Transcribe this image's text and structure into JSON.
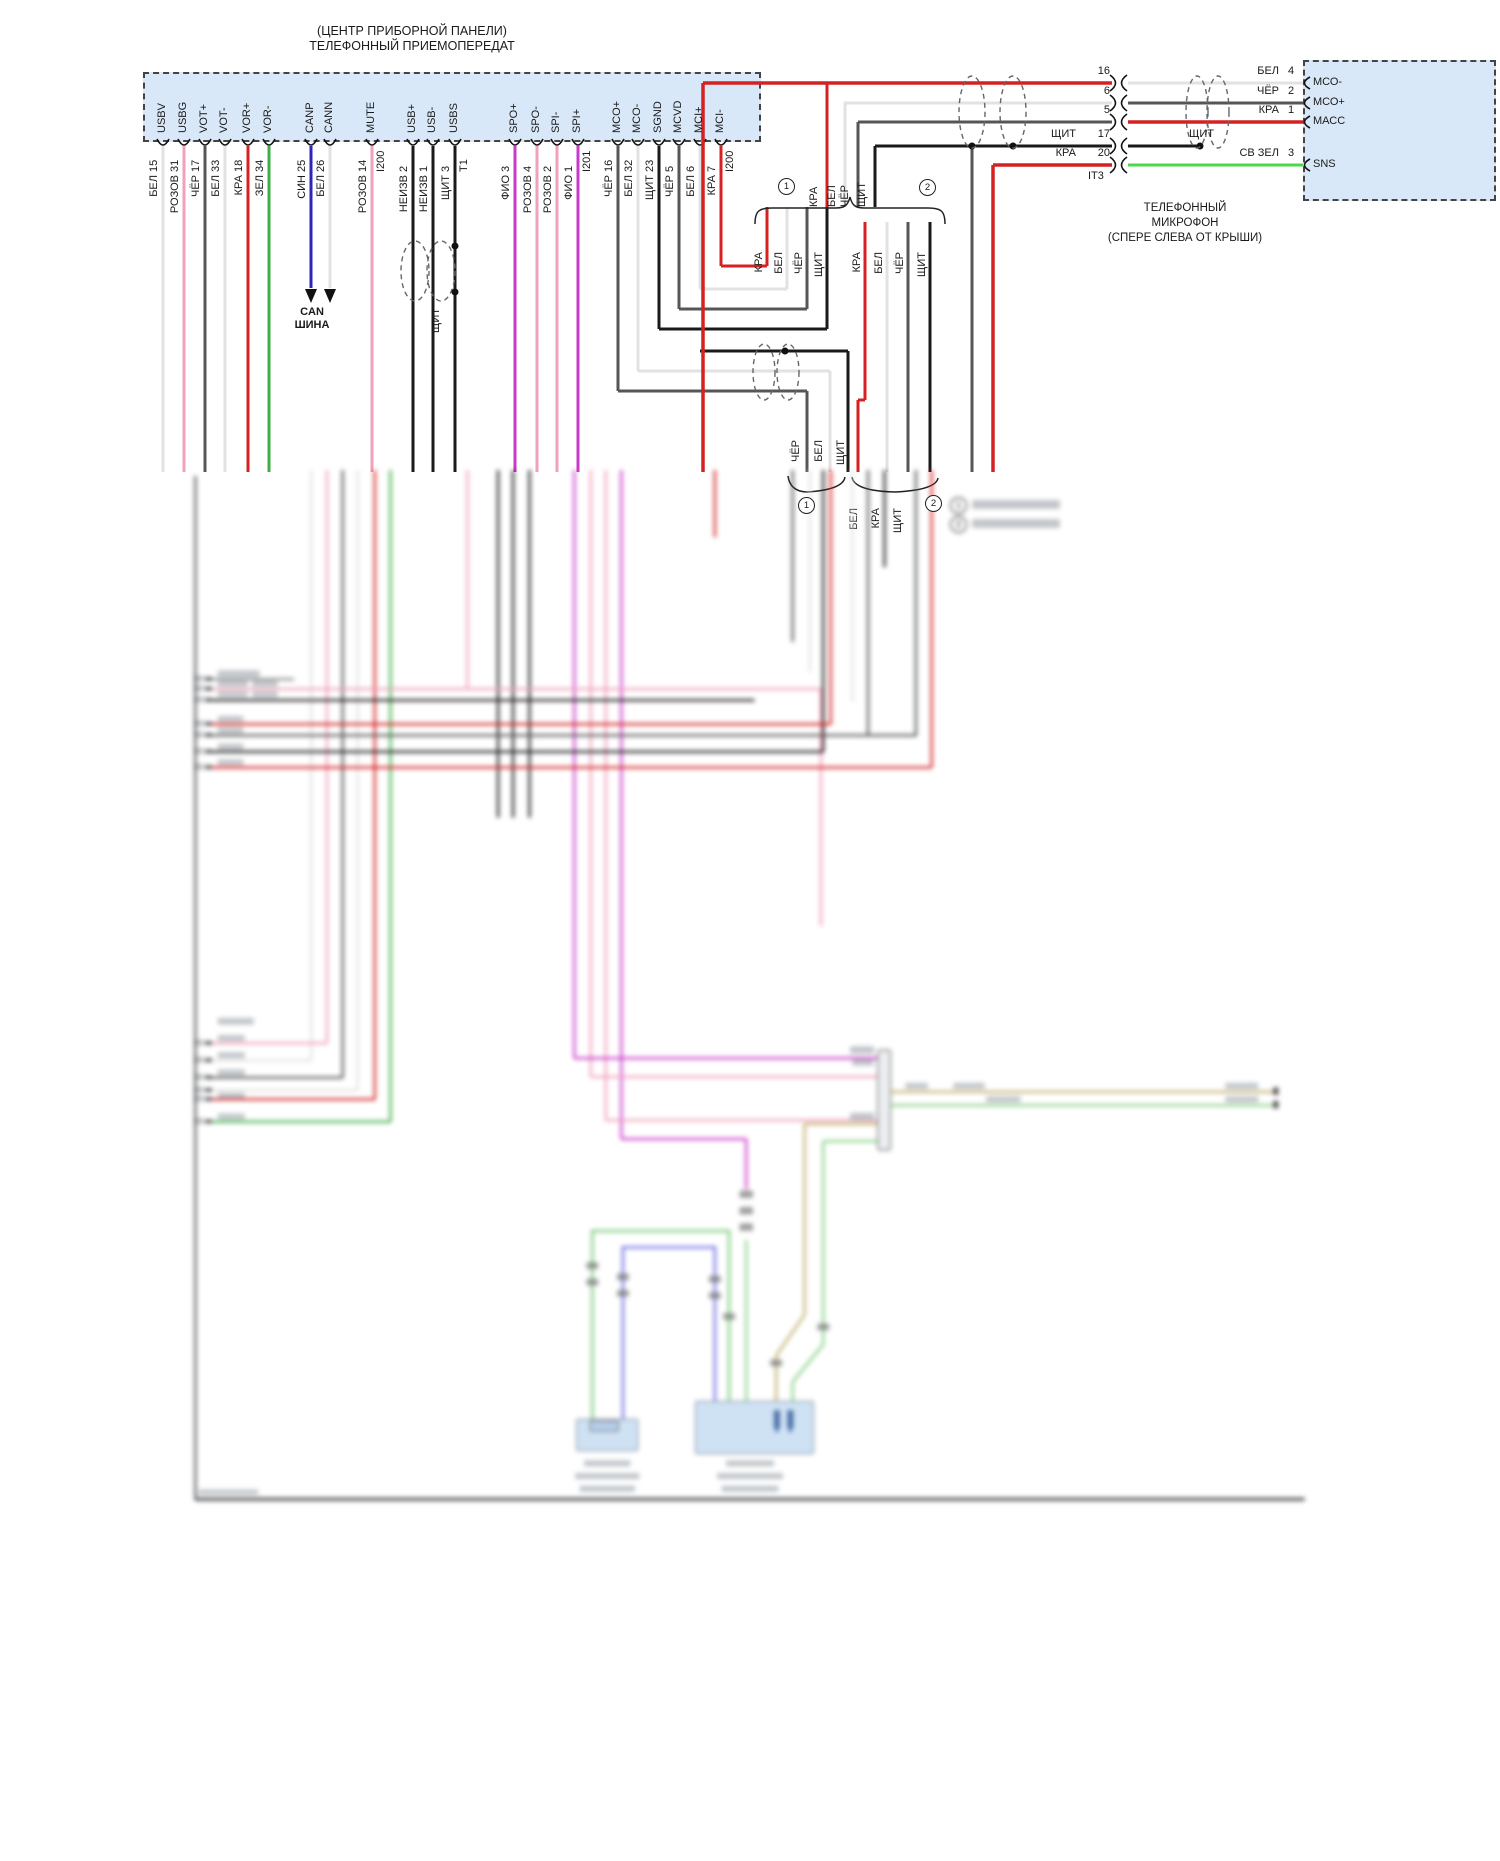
{
  "palette": {
    "BEL": "#e2e2e2",
    "ROZOV": "#f0a2ba",
    "CHER": "#565656",
    "KRA": "#d42222",
    "ZEL": "#3fae47",
    "SIN": "#2c24bd",
    "NEIZV": "#1a1a1a",
    "SHCHIT": "#1a1a1a",
    "FIO": "#c93ac9",
    "SVZEL": "#4ad84a",
    "TAN": "#c0ad6c",
    "BLUE2": "#8080e8",
    "GREEN2": "#86cf86",
    "block_fill": "#d9e8f8"
  },
  "header": {
    "title_line1": "(ЦЕНТР ПРИБОРНОЙ ПАНЕЛИ)",
    "title_line2": "ТЕЛЕФОННЫЙ ПРИЕМОПЕРЕДАТ"
  },
  "transceiver_pins": [
    {
      "label": "USBV",
      "num": "15",
      "wire": "БЕЛ",
      "color": "BEL"
    },
    {
      "label": "USBG",
      "num": "31",
      "wire": "РОЗОВ",
      "color": "ROZOV"
    },
    {
      "label": "VOT+",
      "num": "17",
      "wire": "ЧЁР",
      "color": "CHER"
    },
    {
      "label": "VOT-",
      "num": "33",
      "wire": "БЕЛ",
      "color": "BEL"
    },
    {
      "label": "VOR+",
      "num": "18",
      "wire": "КРА",
      "color": "KRA"
    },
    {
      "label": "VOR-",
      "num": "34",
      "wire": "ЗЕЛ",
      "color": "ZEL"
    },
    {
      "label": "CANP",
      "num": "25",
      "wire": "СИН",
      "color": "SIN"
    },
    {
      "label": "CANN",
      "num": "26",
      "wire": "БЕЛ",
      "color": "BEL"
    },
    {
      "label": "MUTE",
      "num": "14",
      "wire": "РОЗОВ",
      "color": "ROZOV",
      "conn": "I200"
    },
    {
      "label": "USB+",
      "num": "2",
      "wire": "НЕИЗВ",
      "color": "NEIZV"
    },
    {
      "label": "USB-",
      "num": "1",
      "wire": "НЕИЗВ",
      "color": "NEIZV"
    },
    {
      "label": "USBS",
      "num": "3",
      "wire": "ЩИТ",
      "color": "SHCHIT",
      "conn": "T1"
    },
    {
      "label": "SPO+",
      "num": "3",
      "wire": "ФИО",
      "color": "FIO"
    },
    {
      "label": "SPO-",
      "num": "4",
      "wire": "РОЗОВ",
      "color": "ROZOV"
    },
    {
      "label": "SPI-",
      "num": "2",
      "wire": "РОЗОВ",
      "color": "ROZOV"
    },
    {
      "label": "SPI+",
      "num": "1",
      "wire": "ФИО",
      "color": "FIO",
      "conn": "I201"
    },
    {
      "label": "MCO+",
      "num": "16",
      "wire": "ЧЁР",
      "color": "CHER"
    },
    {
      "label": "MCO-",
      "num": "32",
      "wire": "БЕЛ",
      "color": "BEL"
    },
    {
      "label": "SGND",
      "num": "23",
      "wire": "ЩИТ",
      "color": "SHCHIT"
    },
    {
      "label": "MCVD",
      "num": "5",
      "wire": "ЧЁР",
      "color": "CHER"
    },
    {
      "label": "MCI+",
      "num": "6",
      "wire": "БЕЛ",
      "color": "BEL"
    },
    {
      "label": "MCI-",
      "num": "7",
      "wire": "КРА",
      "color": "KRA",
      "conn": "I200"
    }
  ],
  "can_bus": {
    "line1": "CAN",
    "line2": "ШИНА"
  },
  "labels": {
    "shield": "ЩИТ"
  },
  "mid": {
    "bundle_top": [
      "КРА",
      "БЕЛ",
      "ЧЁР",
      "ЩИТ"
    ],
    "group1": [
      "КРА",
      "БЕЛ",
      "ЧЁР",
      "ЩИТ"
    ],
    "group2": [
      "КРА",
      "БЕЛ",
      "ЧЁР",
      "ЩИТ"
    ],
    "trio1": [
      "ЧЁР",
      "БЕЛ",
      "ЩИТ"
    ],
    "trio2": [
      "БЕЛ",
      "КРА",
      "ЩИТ"
    ],
    "marker1": "1",
    "marker2": "2"
  },
  "mic": {
    "rows": [
      {
        "num_left": "16",
        "wire_right": "БЕЛ",
        "num_right": "4",
        "pin": "МСО-"
      },
      {
        "num_left": "6",
        "wire_right": "ЧЁР",
        "num_right": "2",
        "pin": "МСО+"
      },
      {
        "num_left": "5",
        "wire_right": "КРА",
        "num_right": "1",
        "pin": "МАСС"
      },
      {
        "num_left": "17",
        "label_left": "ЩИТ",
        "wire_right": "ЩИТ",
        "num_right": "",
        "pin": ""
      },
      {
        "num_left": "20",
        "label_left": "КРА",
        "wire_right": "СВ ЗЕЛ",
        "num_right": "3",
        "pin": "SNS"
      }
    ],
    "conn_id": "IT3",
    "name_line1": "ТЕЛЕФОННЫЙ",
    "name_line2": "МИКРОФОН",
    "name_line3": "(СПЕРЕ СЛЕВА ОТ КРЫШИ)"
  },
  "legend": [
    {
      "marker": "1"
    },
    {
      "marker": "2"
    }
  ]
}
